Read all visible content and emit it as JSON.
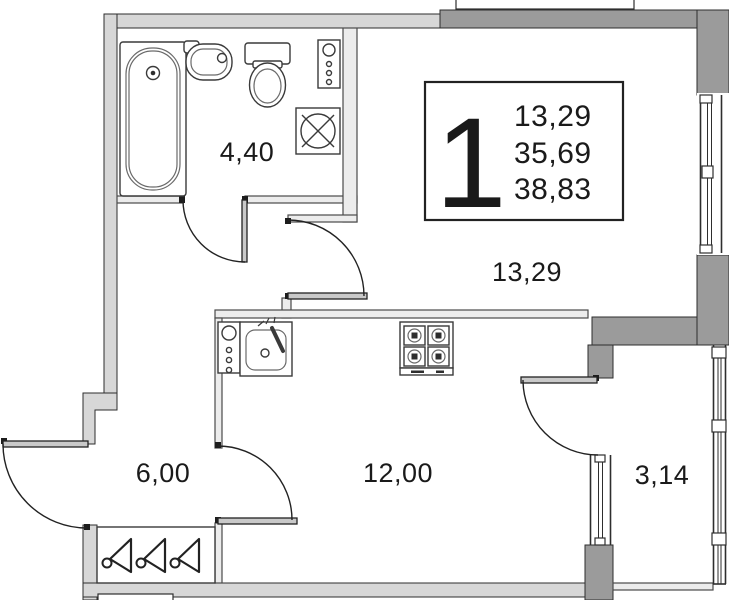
{
  "info_box": {
    "room_count": "1",
    "values": [
      "13,29",
      "35,69",
      "38,83"
    ]
  },
  "rooms": {
    "bathroom": {
      "area": "4,40"
    },
    "living_room": {
      "area": "13,29"
    },
    "hallway": {
      "area": "6,00"
    },
    "kitchen": {
      "area": "12,00"
    },
    "balcony": {
      "area": "3,14"
    }
  },
  "icons": [
    "bathtub-icon",
    "bath-sink-icon",
    "toilet-icon",
    "utility-panel-icon",
    "washing-machine-icon",
    "kitchen-utility-panel-icon",
    "kitchen-sink-icon",
    "stove-icon",
    "hanger-icon",
    "window-icon",
    "door-icon"
  ],
  "colors": {
    "wall_dark": "#9b9b9b",
    "wall_light": "#d7d7d7",
    "line": "#222222",
    "background": "#ffffff"
  }
}
